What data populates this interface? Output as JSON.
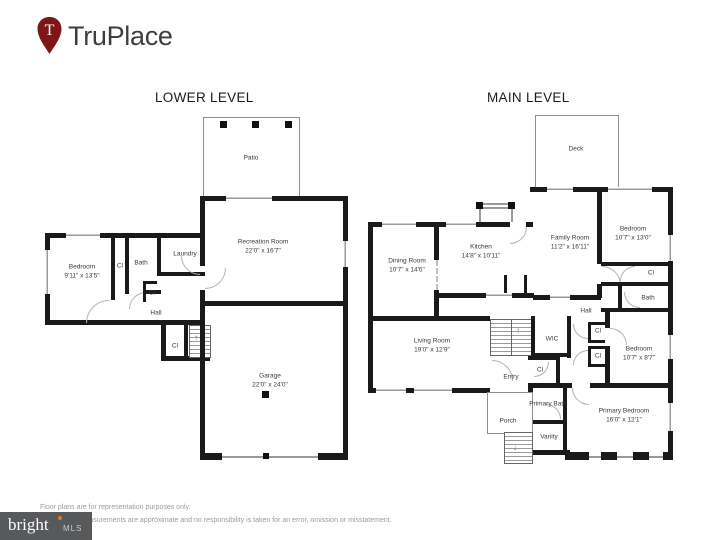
{
  "header": {
    "brand": "TruPlace",
    "pin_letter": "T"
  },
  "colors": {
    "wall": "#1A1A1A",
    "brand_red": "#7E1517",
    "mls_gray": "#58595B",
    "mls_accent": "#E87722",
    "disclaimer_text": "#9B9B9B"
  },
  "icons": {
    "stairs_up_arrow": "↑",
    "stairs_down_arrow": "↓"
  },
  "floors": {
    "lower": {
      "title": "LOWER LEVEL",
      "patio": {
        "name": "Patio"
      },
      "recreation": {
        "name": "Recreation Room",
        "dims": "22'0\" x 16'7\""
      },
      "bedroom": {
        "name": "Bedroom",
        "dims": "9'11\" x 13'5\""
      },
      "cl1": {
        "name": "Cl"
      },
      "bath": {
        "name": "Bath"
      },
      "laundry": {
        "name": "Laundry"
      },
      "cl2": {
        "name": "Cl"
      },
      "hall": {
        "name": "Hall"
      },
      "cl3": {
        "name": "Cl"
      },
      "garage": {
        "name": "Garage",
        "dims": "22'0\" x 24'0\""
      }
    },
    "main": {
      "title": "MAIN LEVEL",
      "deck": {
        "name": "Deck"
      },
      "dining": {
        "name": "Dining Room",
        "dims": "10'7\" x 14'6\""
      },
      "kitchen": {
        "name": "Kitchen",
        "dims": "14'8\" x 10'11\""
      },
      "family": {
        "name": "Family Room",
        "dims": "11'2\" x 16'11\""
      },
      "bedroom1": {
        "name": "Bedroom",
        "dims": "10'7\" x 13'0\""
      },
      "cl1": {
        "name": "Cl"
      },
      "bath": {
        "name": "Bath"
      },
      "hall": {
        "name": "Hall"
      },
      "living": {
        "name": "Living Room",
        "dims": "19'0\" x 12'9\""
      },
      "wic": {
        "name": "WIC"
      },
      "cl2": {
        "name": "Cl"
      },
      "cl3": {
        "name": "Cl"
      },
      "cl4": {
        "name": "Cl"
      },
      "bedroom2": {
        "name": "Bedroom",
        "dims": "10'7\" x 8'7\""
      },
      "entry": {
        "name": "Entry"
      },
      "primary_bath": {
        "name": "Primary Bath"
      },
      "porch": {
        "name": "Porch"
      },
      "vanity": {
        "name": "Vanity"
      },
      "primary_bedroom": {
        "name": "Primary Bedroom",
        "dims": "16'0\" x 12'1\""
      }
    }
  },
  "footer": {
    "disclaimer_line1": "Floor plans are for representation purposes only.",
    "disclaimer_line2": "and measurements are approximate and no responsibility is taken for an error, omission or misstatement.",
    "mls_brand": "bright",
    "mls_sub": "MLS"
  }
}
